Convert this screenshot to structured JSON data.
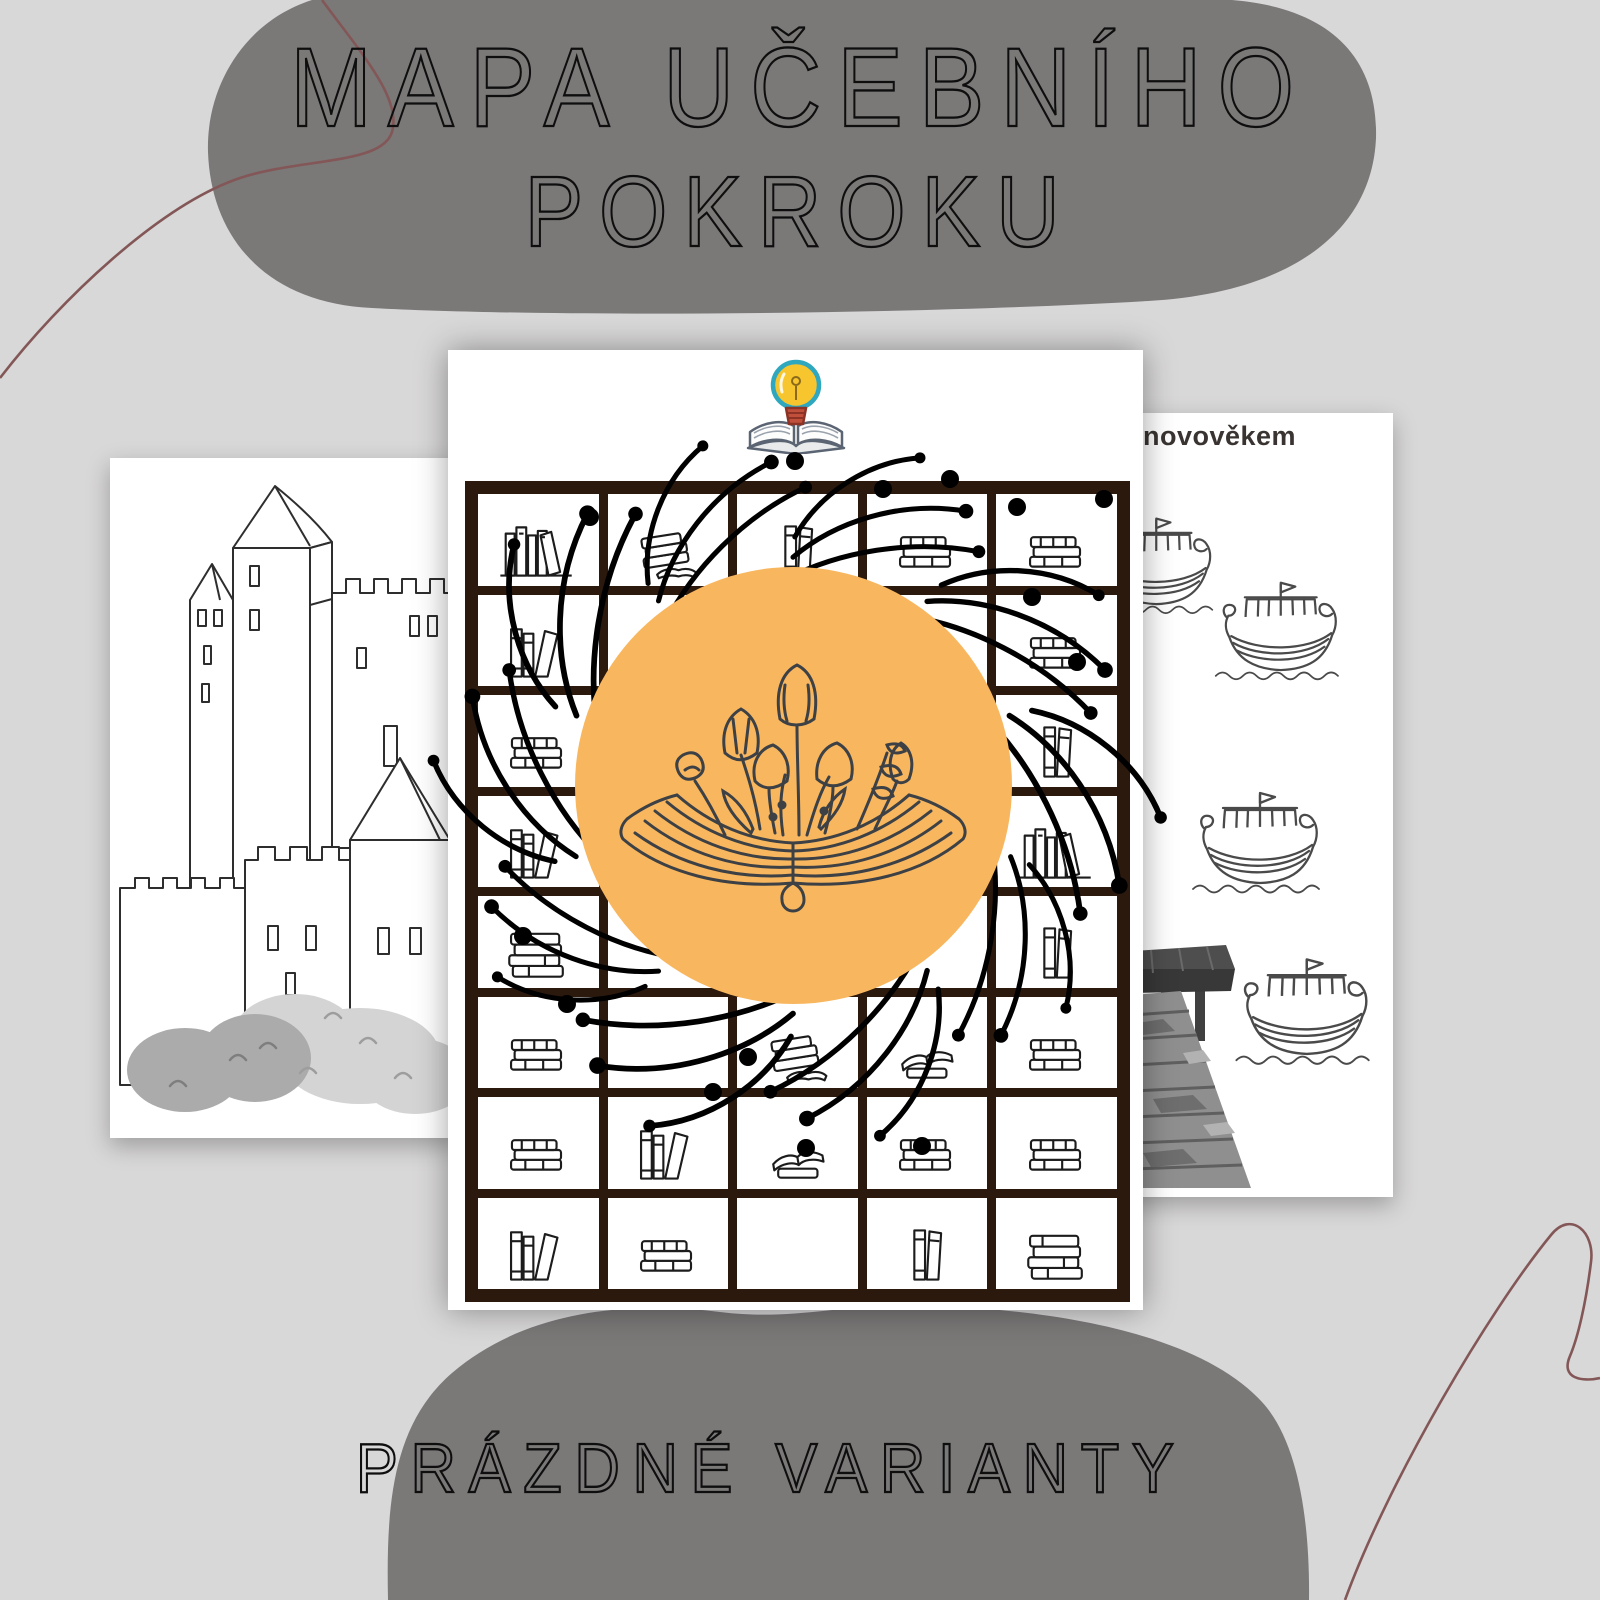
{
  "poster": {
    "title_line1": "MAPA UČEBNÍHO",
    "title_line2": "POKROKU",
    "subtitle": "PRÁZDNÉ VARIANTY"
  },
  "left_page": {
    "illustration": "castle-coloring-page"
  },
  "center_page": {
    "logo_icon": "lightbulb-book-logo",
    "medallion_icon": "open-book-flowers",
    "grid": {
      "rows": 8,
      "cols": 5,
      "cells": [
        [
          "books-row",
          "tilted-stack",
          "standing-pair",
          "flat-stack",
          "flat-stack"
        ],
        [
          "leaning-books",
          "standing-pair",
          "",
          "tilted-stack",
          "flat-stack"
        ],
        [
          "flat-stack",
          "",
          "",
          "",
          "standing-pair"
        ],
        [
          "leaning-books",
          "",
          "",
          "",
          "books-row"
        ],
        [
          "tall-stack",
          "",
          "",
          "",
          "standing-pair"
        ],
        [
          "flat-stack",
          "",
          "tilted-stack",
          "open-stack",
          "flat-stack"
        ],
        [
          "flat-stack",
          "leaning-books",
          "open-stack",
          "flat-stack",
          "flat-stack"
        ],
        [
          "leaning-books",
          "flat-stack",
          "",
          "standing-pair",
          "tall-stack"
        ]
      ]
    }
  },
  "right_page": {
    "heading": "novověkem",
    "ship_count": 4,
    "illustrations": [
      "viking-ship",
      "wooden-pier"
    ]
  },
  "colors": {
    "background": "#d9d8d8",
    "blob": "#7b7878",
    "title_ink": "#0e0e0e",
    "orange": "#f8b75f",
    "grid_brown": "#2c190d",
    "accent_line": "#835757",
    "line_art": "#3d4145",
    "heading_ink": "#393431"
  }
}
